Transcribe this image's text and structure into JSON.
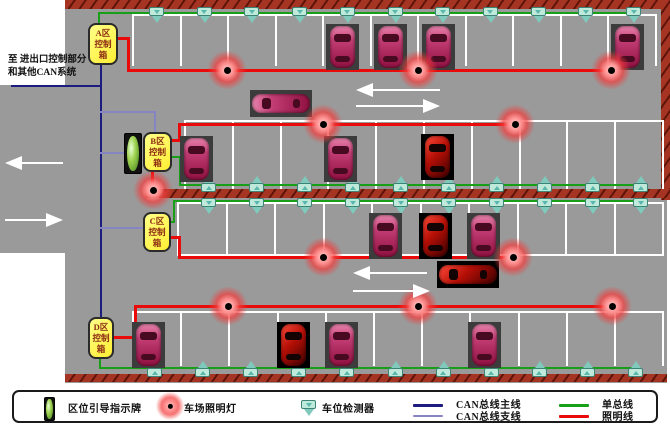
{
  "annotation": {
    "line1": "至 进出口控制部分",
    "line2": "和其他CAN系统"
  },
  "control_boxes": [
    {
      "id": "A",
      "label": "A区控制箱",
      "x": 88,
      "y": 23,
      "w": 30,
      "h": 42
    },
    {
      "id": "B",
      "label": "B区控制箱",
      "x": 143,
      "y": 132,
      "w": 29,
      "h": 40
    },
    {
      "id": "C",
      "label": "C区控制箱",
      "x": 143,
      "y": 212,
      "w": 28,
      "h": 40
    },
    {
      "id": "D",
      "label": "D区控制箱",
      "x": 88,
      "y": 317,
      "w": 26,
      "h": 42
    }
  ],
  "legend": {
    "items": [
      {
        "type": "sign",
        "label": "区位引导指示牌",
        "icon_x": 30,
        "text_x": 54,
        "row": -1
      },
      {
        "type": "light",
        "label": "车场照明灯",
        "icon_x": 148,
        "text_x": 170,
        "row": -1
      },
      {
        "type": "detector",
        "label": "车位检测器",
        "icon_x": 287,
        "text_x": 308,
        "row": -1
      },
      {
        "type": "line",
        "color": "can_main",
        "label": "CAN总线主线",
        "icon_x": 399,
        "text_x": 442,
        "row": 0
      },
      {
        "type": "line",
        "color": "can_branch",
        "label": "CAN总线支线",
        "icon_x": 399,
        "text_x": 442,
        "row": 1
      },
      {
        "type": "line",
        "color": "single_bus",
        "label": "单总线",
        "icon_x": 545,
        "text_x": 588,
        "row": 0
      },
      {
        "type": "line",
        "color": "lighting",
        "label": "照明线",
        "icon_x": 545,
        "text_x": 588,
        "row": 1
      }
    ]
  },
  "colors": {
    "lot": "#9a9a9a",
    "can_main": "#1c1c7e",
    "can_branch": "#8585c4",
    "single_bus": "#17a017",
    "lighting": "#ea0a0a",
    "box_bg": "#ffee33",
    "detector": "#bfe9d9",
    "car_body": "#c23d74",
    "car_special": "#cf1111"
  },
  "ground": {
    "main": {
      "x": 65,
      "y": 0,
      "w": 602,
      "h": 383
    },
    "corridor": {
      "x": 0,
      "y": 85,
      "w": 65,
      "h": 168
    }
  },
  "walls": [
    {
      "x": 65,
      "y": 0,
      "w": 605,
      "h": 9
    },
    {
      "x": 661,
      "y": 0,
      "w": 9,
      "h": 200
    },
    {
      "x": 145,
      "y": 189,
      "w": 525,
      "h": 9
    },
    {
      "x": 65,
      "y": 374,
      "w": 602,
      "h": 8
    }
  ],
  "parking_rows": [
    {
      "x0": 133,
      "pitch": 47.5,
      "count": 12,
      "y1": 15,
      "y2": 65,
      "top": true,
      "bottom": false
    },
    {
      "x0": 185,
      "pitch": 47.8,
      "count": 11,
      "y1": 121,
      "y2": 188,
      "top": true,
      "bottom": false
    },
    {
      "x0": 178,
      "pitch": 48.5,
      "count": 11,
      "y1": 203,
      "y2": 255,
      "top": true,
      "bottom": true
    },
    {
      "x0": 133,
      "pitch": 48.2,
      "count": 12,
      "y1": 312,
      "y2": 365,
      "top": true,
      "bottom": false
    }
  ],
  "bus_lines": [
    {
      "c": "can_main",
      "w": 2.5,
      "pts": [
        [
          12,
          86
        ],
        [
          101,
          86
        ]
      ]
    },
    {
      "c": "can_main",
      "w": 2.5,
      "pts": [
        [
          101,
          64
        ],
        [
          101,
          318
        ]
      ]
    },
    {
      "c": "can_branch",
      "w": 2,
      "pts": [
        [
          101,
          112
        ],
        [
          155,
          112
        ],
        [
          155,
          133
        ]
      ]
    },
    {
      "c": "can_branch",
      "w": 2,
      "pts": [
        [
          101,
          153
        ],
        [
          124,
          153
        ]
      ]
    },
    {
      "c": "can_branch",
      "w": 2,
      "pts": [
        [
          101,
          228
        ],
        [
          143,
          228
        ]
      ]
    },
    {
      "c": "single_bus",
      "w": 2.5,
      "pts": [
        [
          99,
          23
        ],
        [
          99,
          13
        ],
        [
          638,
          13
        ]
      ]
    },
    {
      "c": "single_bus",
      "w": 2.5,
      "pts": [
        [
          172,
          157
        ],
        [
          180,
          157
        ],
        [
          180,
          185
        ],
        [
          640,
          185
        ]
      ]
    },
    {
      "c": "single_bus",
      "w": 2.5,
      "pts": [
        [
          171,
          222
        ],
        [
          174,
          222
        ],
        [
          174,
          201
        ],
        [
          640,
          201
        ]
      ]
    },
    {
      "c": "single_bus",
      "w": 2.5,
      "pts": [
        [
          100,
          358
        ],
        [
          100,
          368
        ],
        [
          640,
          368
        ]
      ]
    },
    {
      "c": "lighting",
      "w": 3,
      "pts": [
        [
          118,
          38
        ],
        [
          128,
          38
        ],
        [
          128,
          70
        ],
        [
          611,
          70
        ]
      ]
    },
    {
      "c": "lighting",
      "w": 3,
      "pts": [
        [
          172,
          140
        ],
        [
          179,
          140
        ],
        [
          179,
          124
        ],
        [
          515,
          124
        ]
      ]
    },
    {
      "c": "lighting",
      "w": 3,
      "pts": [
        [
          152,
          172
        ],
        [
          152,
          190
        ]
      ]
    },
    {
      "c": "lighting",
      "w": 3,
      "pts": [
        [
          171,
          237
        ],
        [
          179,
          237
        ],
        [
          179,
          257
        ],
        [
          513,
          257
        ]
      ]
    },
    {
      "c": "lighting",
      "w": 3,
      "pts": [
        [
          113,
          337
        ],
        [
          135,
          337
        ],
        [
          135,
          306
        ],
        [
          612,
          306
        ]
      ]
    }
  ],
  "detector_rows": [
    {
      "y": 14,
      "x0": 157,
      "pitch": 47.7,
      "count": 11,
      "dir": "down"
    },
    {
      "y": 181,
      "x0": 209,
      "pitch": 48,
      "count": 10,
      "dir": "up"
    },
    {
      "y": 205,
      "x0": 209,
      "pitch": 48,
      "count": 10,
      "dir": "down"
    },
    {
      "y": 366,
      "x0": 155,
      "pitch": 48.1,
      "count": 11,
      "dir": "up"
    }
  ],
  "lights": [
    [
      227,
      70
    ],
    [
      418,
      70
    ],
    [
      611,
      70
    ],
    [
      323,
      124
    ],
    [
      515,
      124
    ],
    [
      153,
      190
    ],
    [
      323,
      257
    ],
    [
      513,
      257
    ],
    [
      228,
      306
    ],
    [
      418,
      306
    ],
    [
      612,
      306
    ]
  ],
  "cars": [
    {
      "x": 349,
      "y": 40,
      "o": "v",
      "t": "pink"
    },
    {
      "x": 397,
      "y": 40,
      "o": "v",
      "t": "pink"
    },
    {
      "x": 445,
      "y": 40,
      "o": "v",
      "t": "pink"
    },
    {
      "x": 634,
      "y": 40,
      "o": "v",
      "t": "pink"
    },
    {
      "x": 203,
      "y": 152,
      "o": "v",
      "t": "pink"
    },
    {
      "x": 347,
      "y": 152,
      "o": "v",
      "t": "pink"
    },
    {
      "x": 444,
      "y": 150,
      "o": "v",
      "t": "special"
    },
    {
      "x": 281,
      "y": 103,
      "o": "h",
      "t": "pink"
    },
    {
      "x": 392,
      "y": 229,
      "o": "v",
      "t": "pink"
    },
    {
      "x": 442,
      "y": 229,
      "o": "v",
      "t": "special"
    },
    {
      "x": 490,
      "y": 229,
      "o": "v",
      "t": "pink"
    },
    {
      "x": 468,
      "y": 274,
      "o": "h",
      "t": "special"
    },
    {
      "x": 155,
      "y": 338,
      "o": "v",
      "t": "pink"
    },
    {
      "x": 300,
      "y": 338,
      "o": "v",
      "t": "special"
    },
    {
      "x": 348,
      "y": 338,
      "o": "v",
      "t": "pink"
    },
    {
      "x": 491,
      "y": 338,
      "o": "v",
      "t": "pink"
    }
  ],
  "guidance_sign": {
    "x": 124,
    "y": 133,
    "w": 16,
    "h": 39
  },
  "arrows": [
    {
      "x": 5,
      "y": 163,
      "w": 58,
      "dir": "left"
    },
    {
      "x": 5,
      "y": 220,
      "w": 58,
      "dir": "right"
    },
    {
      "x": 356,
      "y": 90,
      "w": 84,
      "dir": "left"
    },
    {
      "x": 356,
      "y": 106,
      "w": 84,
      "dir": "right"
    },
    {
      "x": 353,
      "y": 273,
      "w": 74,
      "dir": "left"
    },
    {
      "x": 353,
      "y": 291,
      "w": 77,
      "dir": "right"
    }
  ]
}
